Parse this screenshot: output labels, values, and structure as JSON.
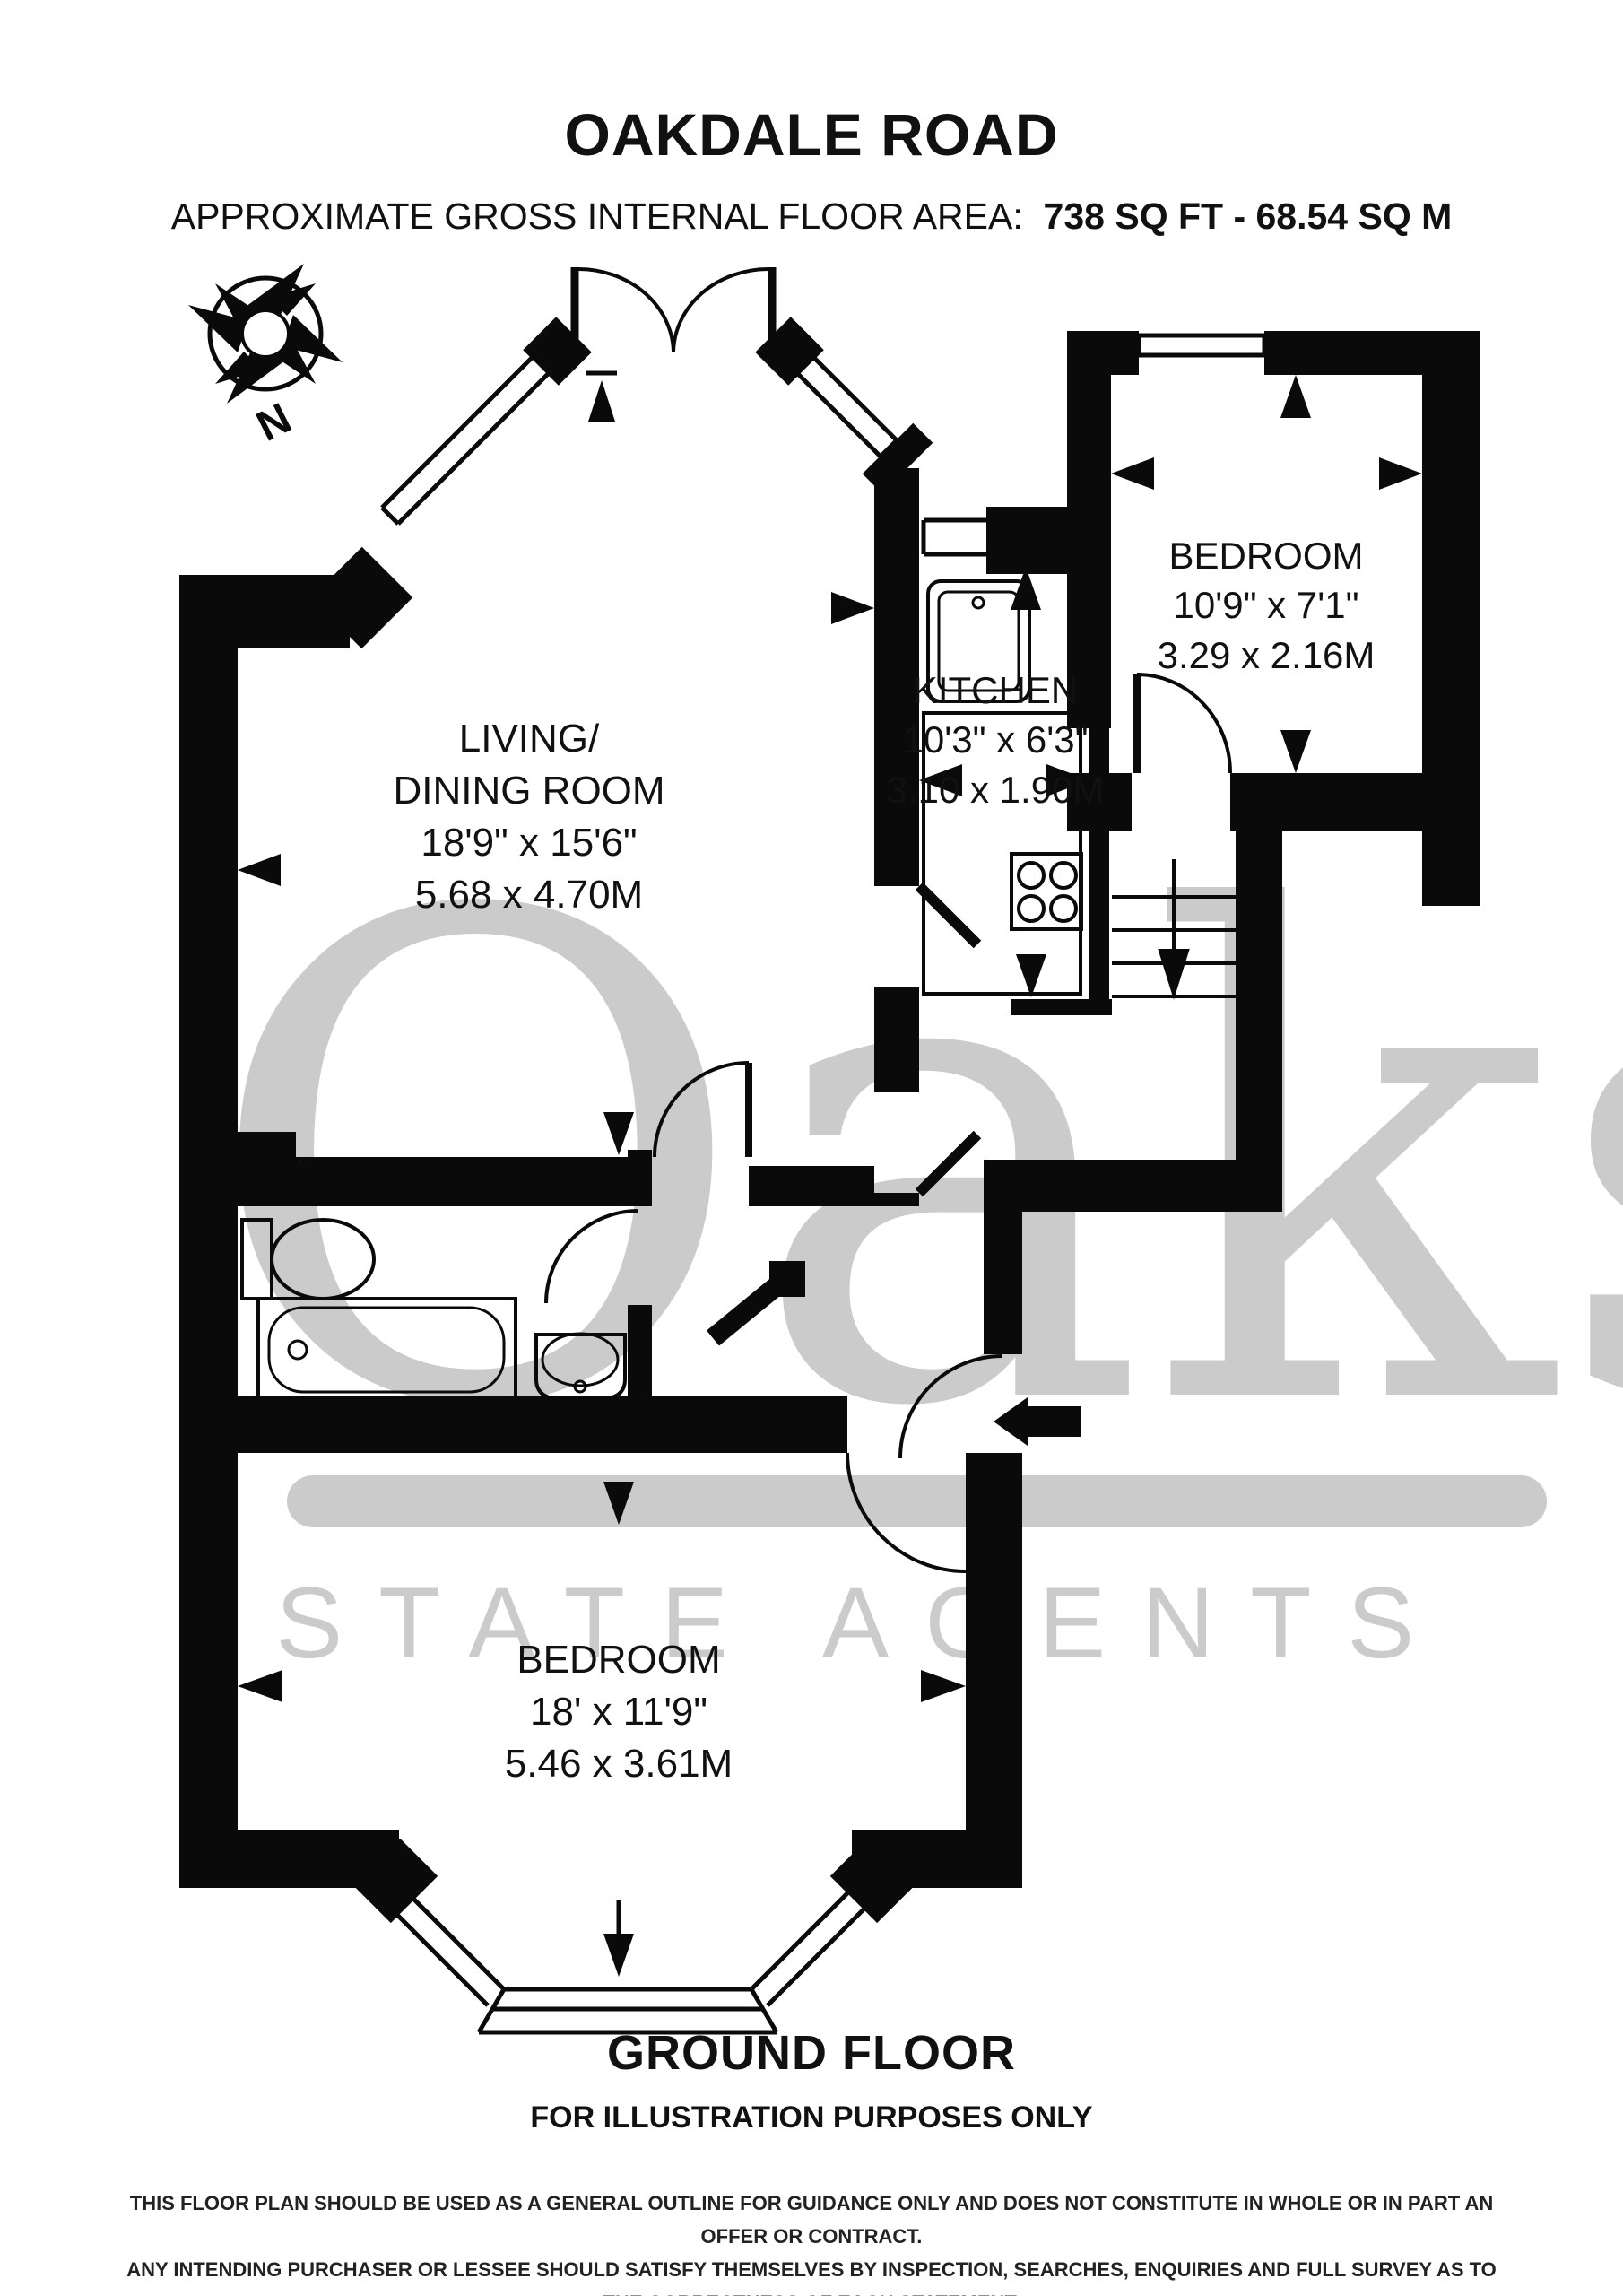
{
  "title": "OAKDALE ROAD",
  "subtitle": {
    "label": "APPROXIMATE GROSS INTERNAL FLOOR AREA:",
    "value": "738 SQ FT - 68.54 SQ M"
  },
  "compass": {
    "north_label": "N"
  },
  "rooms": {
    "living_dining": {
      "name_line1": "LIVING/",
      "name_line2": "DINING ROOM",
      "size_imperial": "18'9\" x 15'6\"",
      "size_metric": "5.68 x 4.70M"
    },
    "kitchen": {
      "name": "KITCHEN",
      "size_imperial": "10'3\" x 6'3\"",
      "size_metric": "3.10 x 1.90M"
    },
    "bedroom_right": {
      "name": "BEDROOM",
      "size_imperial": "10'9\" x 7'1\"",
      "size_metric": "3.29 x 2.16M"
    },
    "bedroom_bottom": {
      "name": "BEDROOM",
      "size_imperial": "18' x 11'9\"",
      "size_metric": "5.46 x 3.61M"
    }
  },
  "watermark": {
    "brand": "Oaks",
    "tagline": "ESTATE AGENTS",
    "color": "#cbcbcb"
  },
  "footer": {
    "floor_label": "GROUND FLOOR",
    "illustration_note": "FOR ILLUSTRATION PURPOSES ONLY",
    "disclaimer_lines": [
      "THIS FLOOR PLAN SHOULD BE USED AS A GENERAL OUTLINE FOR GUIDANCE ONLY AND DOES NOT CONSTITUTE IN WHOLE OR IN PART AN OFFER OR CONTRACT.",
      "ANY INTENDING PURCHASER OR LESSEE SHOULD SATISFY THEMSELVES BY INSPECTION, SEARCHES, ENQUIRIES AND FULL SURVEY AS TO THE CORRECTNESS OF EACH STATEMENT.",
      "ANY AREAS, MEASUREMENTS OR DISTANCES QUOTED ARE APPROXIMATE AND SHOULD NOT BE USED TO VALUE A PROPERTY OR BE THE BASIS OF ANY SALE OR LET."
    ]
  },
  "plan": {
    "wall_color": "#000000",
    "background_color": "#ffffff"
  }
}
